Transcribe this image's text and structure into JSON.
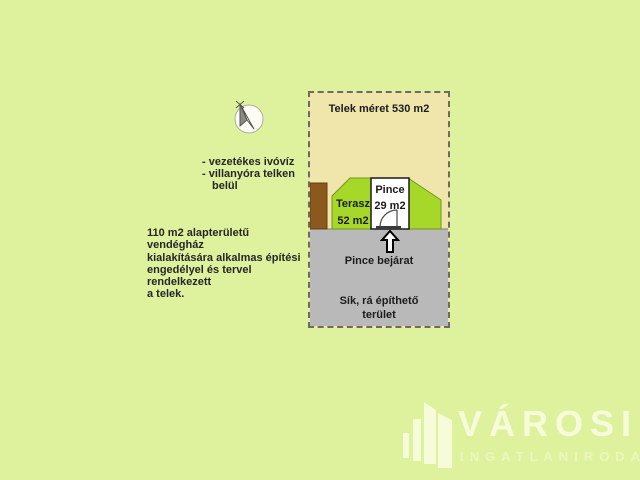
{
  "notes": {
    "bullets": [
      "- vezetékes ivóvíz",
      "- villanyóra telken",
      "belül"
    ],
    "paragraph_lines": [
      "110 m2 alapterületű vendégház",
      "kialakítására alkalmas építési",
      "engedélyel és tervel rendelkezett",
      "a telek."
    ]
  },
  "plot": {
    "size_label": "Telek méret 530 m2",
    "terasz_label": "Terasz",
    "terasz_area": "52 m2",
    "pince_label": "Pince",
    "pince_area": "29 m2",
    "entrance_label": "Pince bejárat",
    "buildable_lines": [
      "Sík, rá építhető",
      "terület"
    ]
  },
  "icons": {
    "compass": "north-arrow-icon",
    "entrance_arrow": "up-arrow-icon",
    "logo_building": "buildings-icon"
  },
  "colors": {
    "background": "#def29e",
    "lot": "#f0e6ac",
    "terrace_green": "#a6d829",
    "cellar_white": "#ffffff",
    "flat_area_gray": "#b9b9b9",
    "shed_brown": "#8a591b",
    "logo_white": "#f6fbda"
  },
  "logo": {
    "title": "VÁROSI",
    "subtitle": "INGATLANIRODA"
  }
}
